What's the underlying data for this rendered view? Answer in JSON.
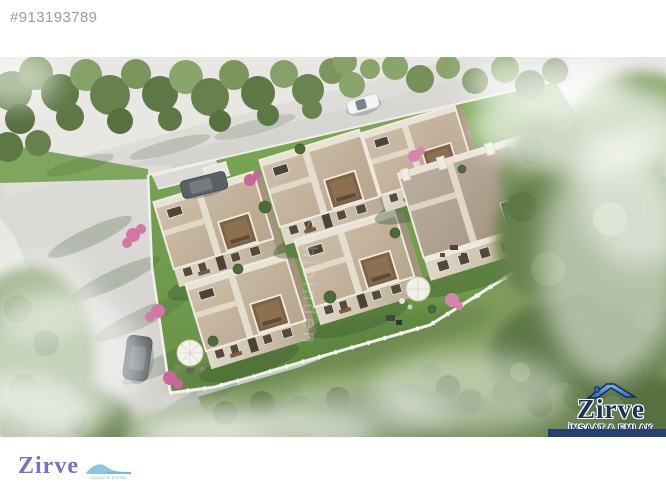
{
  "page": {
    "width": 666,
    "height": 500,
    "background": "#ffffff"
  },
  "listing": {
    "id": "#913193789"
  },
  "photo": {
    "site_watermark": "sahibinden",
    "brand_watermark": {
      "name": "Zirve",
      "tagline": "İNŞAAT & EMLAK"
    },
    "colors": {
      "road": "#d7d6d3",
      "estate_lawn": "#74a150",
      "outer_grass": "#7e9b5c",
      "tree_dark": "#5d7846",
      "tree_mid": "#718c55",
      "tree_light": "#8fa873",
      "roof_beige": "#c8b7a0",
      "big_roof_taupe": "#b3a390",
      "stone_wall": "#d9d0bf",
      "white_fence": "#f1efe8",
      "bougainvillea": "#d077a6",
      "watermark_navy": "#1e2e5e",
      "watermark_blue": "#4a86d8",
      "underline_bar": "#24406f"
    }
  },
  "footer": {
    "logo_text": "Zirve",
    "logo_tagline": "İnşaat & Emlak",
    "logo_purple": "#7b70c4",
    "logo_wave_blue": "#8ec6e0"
  }
}
